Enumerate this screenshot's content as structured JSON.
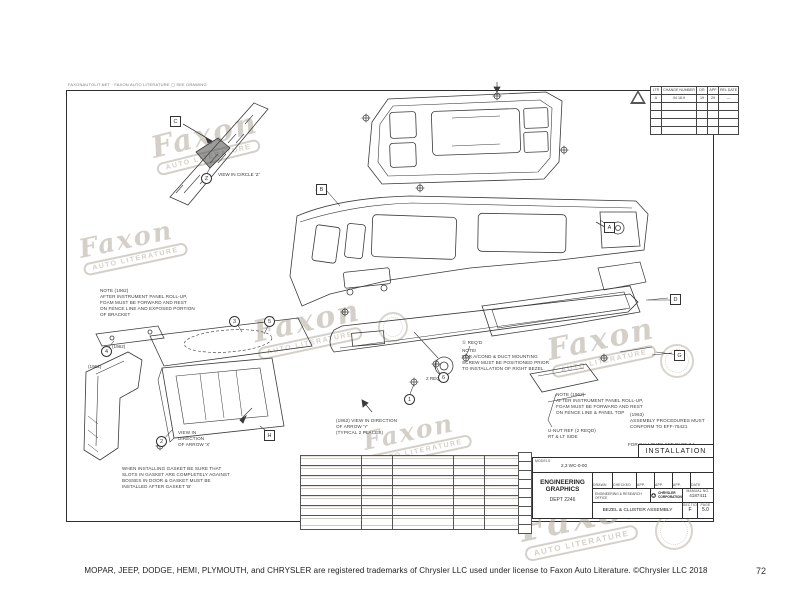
{
  "watermark": {
    "word": "Faxon",
    "subtitle": "AUTO LITERATURE"
  },
  "micro_header": "FAXONAUTOLIT.NET · FAXON AUTO LITERATURE    ▢ SEE DRAWING",
  "revision_table": {
    "headers": [
      "LTR",
      "CHANGE NUMBER",
      "DR",
      "APP",
      "REL DATE"
    ],
    "row": [
      "A",
      "04 18.9",
      "19",
      "29",
      "—"
    ]
  },
  "notes": {
    "callouts_ref": "FOR CALLOUTS SEE PAGE 7.1",
    "left_1962": "NOTE (1962)\nAFTER INSTRUMENT PANEL ROLL-UP,\nFOAM MUST BE FORWARD AND REST\nON FENCE LINE AND EXPOSED PORTION\nOF BRACKET",
    "gasket": "WHEN INSTALLING GASKET BE SURE THAT\nSLOTS IN GASKET ARE COMPLETELY AGAINST\nBOSSES IN DOOR & GASKET MUST BE\nINSTALLED AFTER GASKET 'B'",
    "duct_req": "① REQ'D",
    "duct": "NOTE!\nFOR A/COND & DUCT MOUNTING\nSCREW MUST BE POSITIONED PRIOR\nTO INSTALLATION OF RIGHT BEZEL.",
    "right_1962": "NOTE (1962)\nAFTER INSTRUMENT PANEL ROLL-UP,\nFOAM MUST BE FORWARD AND REST\nON FENCE LINE & PANEL TOP",
    "assy_1963": "(1963)\nASSEMBLY PROCEDURES MUST\nCONFORM TO EFF-75421",
    "unut": "U-NUT REF (2 REQD)\nRT & LT SIDE",
    "view_x": "VIEW IN\nDIRECTION\nOF ARROW 'X'",
    "view_y": "(1962) VIEW IN DIRECTION\nOF ARROW 'Y'\n(TYPICAL 2 PLACES)",
    "view_z": "VIEW IN CIRCLE 'Z'",
    "year_left": "(1962)",
    "year_left2": "(1962)",
    "req2": "2 REQ'D"
  },
  "callouts": {
    "box_c": "C",
    "box_a": "A",
    "box_b": "B",
    "box_d": "D",
    "box_g": "G",
    "box_h": "H",
    "circ_z": "Z",
    "circ_3": "3",
    "circ_5": "5",
    "circ_4": "4",
    "circ_2": "2",
    "circ_1": "1",
    "circ_6": "6"
  },
  "title_block": {
    "installation": "INSTALLATION",
    "models_label": "MODELS",
    "models_value": "2,3 WC-0-00",
    "org_line1": "ENGINEERING",
    "org_line2": "GRAPHICS",
    "org_line3": "DEPT 2246",
    "col_drawn": "DRAWN",
    "col_checked": "CHECKED",
    "col_app1": "APP.",
    "col_app2": "APP.",
    "col_app3": "APP.",
    "col_date": "DATE",
    "sig_drawn": "J.m",
    "sig_checked": "F.Boule",
    "sig_app1": "71",
    "sig_date": "12-4-71",
    "office": "ENGINEERING & RESEARCH OFFICE",
    "brand": "CHRYSLER CORPORATION",
    "manual_label": "MANUAL NO.",
    "manual_no": "4187411",
    "title": "BEZEL & CLUSTER ASSEMBLY",
    "section_label": "SECTION",
    "section_value": "F",
    "page_label": "PAGE",
    "page_value": "5.0"
  },
  "footer": {
    "text": "MOPAR, JEEP, DODGE, HEMI, PLYMOUTH, and CHRYSLER are registered trademarks of Chrysler LLC used under license to Faxon Auto Literature. ©Chrysler LLC 2018",
    "page_number": "72"
  }
}
